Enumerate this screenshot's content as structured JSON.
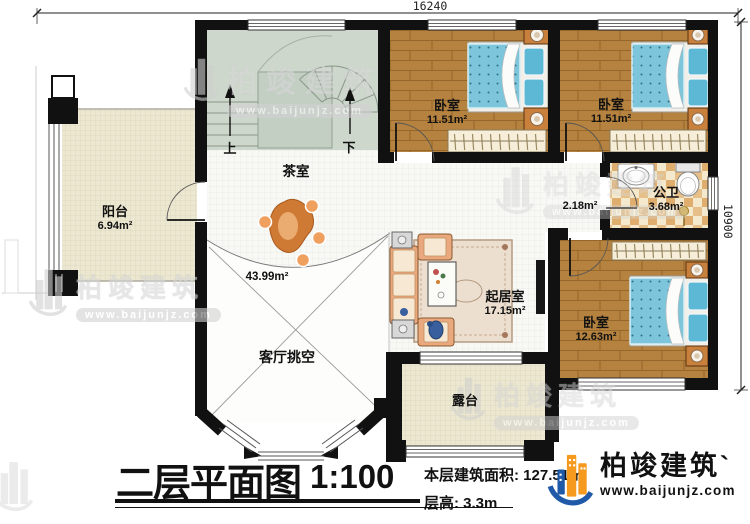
{
  "dimensions": {
    "top": "16240",
    "right": "10900"
  },
  "stairs": {
    "up": "上",
    "down": "下"
  },
  "rooms": {
    "balcony": {
      "name": "阳台",
      "area": "6.94m²"
    },
    "tea_room": {
      "name": "茶室",
      "area": "43.99m²"
    },
    "bedroom_top_mid": {
      "name": "卧室",
      "area": "11.51m²"
    },
    "bedroom_top_right": {
      "name": "卧室",
      "area": "11.51m²"
    },
    "bedroom_right": {
      "name": "卧室",
      "area": "12.63m²"
    },
    "bathroom": {
      "name": "公卫",
      "area": "3.68m²"
    },
    "corridor": {
      "area": "2.18m²"
    },
    "living": {
      "name": "起居室",
      "area": "17.15m²"
    },
    "void": {
      "name": "客厅挑空"
    },
    "terrace": {
      "name": "露台"
    }
  },
  "title_block": {
    "title": "二层平面图",
    "scale": "1:100",
    "area_label": "本层建筑面积: 127.51㎡",
    "floor_height": "层高: 3.3m"
  },
  "brand": {
    "name": "柏竣建筑",
    "tick": "`",
    "url": "www.baijunjz.com"
  },
  "watermark": {
    "name": "柏竣建筑",
    "url": "www.baijunjz.com"
  },
  "colors": {
    "wall": "#111111",
    "wood": "#b5823f",
    "bed": "#7cc5db",
    "khaki": "#ebe7d0",
    "brand_blue": "#2059a8",
    "brand_orange": "#f59a1f"
  }
}
